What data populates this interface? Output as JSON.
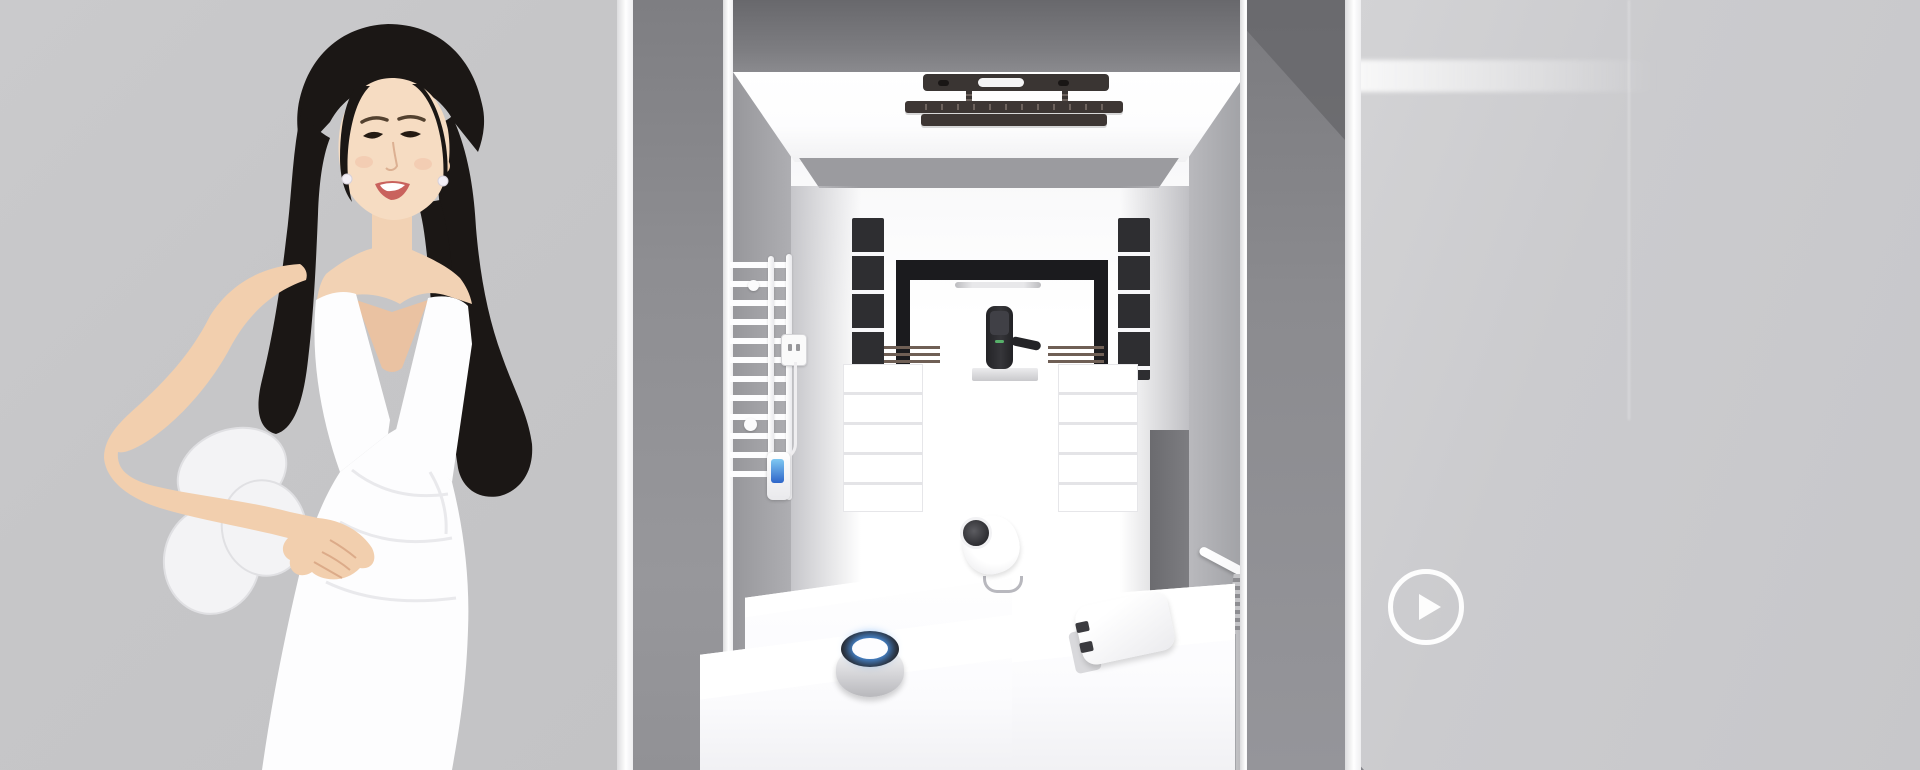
{
  "banner": {
    "kind": "smart-home-showroom-hero",
    "play_button": {
      "icon": "play-icon",
      "shape": "circle-outline"
    }
  },
  "colors": {
    "background_left": "#c6c6c8",
    "background_right": "#cbcbce",
    "pillar_gray": "#8e8e92",
    "top_band_gray": "#68686c",
    "interior_white": "#ffffff",
    "black_frame": "#1b1b1e",
    "lock_body": "#2c2c2f",
    "lock_indicator_green": "#57b06a",
    "drying_rack_dark": "#3a3533",
    "speaker_led_blue": "#4f9ef8",
    "towel_display_blue": "#3f7fd9",
    "play_button_white": "#ffffff"
  },
  "products": [
    {
      "name": "ceiling-drying-rack"
    },
    {
      "name": "heated-towel-rack"
    },
    {
      "name": "wall-socket"
    },
    {
      "name": "smart-door-lock"
    },
    {
      "name": "smart-camera"
    },
    {
      "name": "smart-speaker"
    },
    {
      "name": "smart-hub-gateway"
    }
  ],
  "model": {
    "name": "spokesmodel-in-white-dress"
  }
}
